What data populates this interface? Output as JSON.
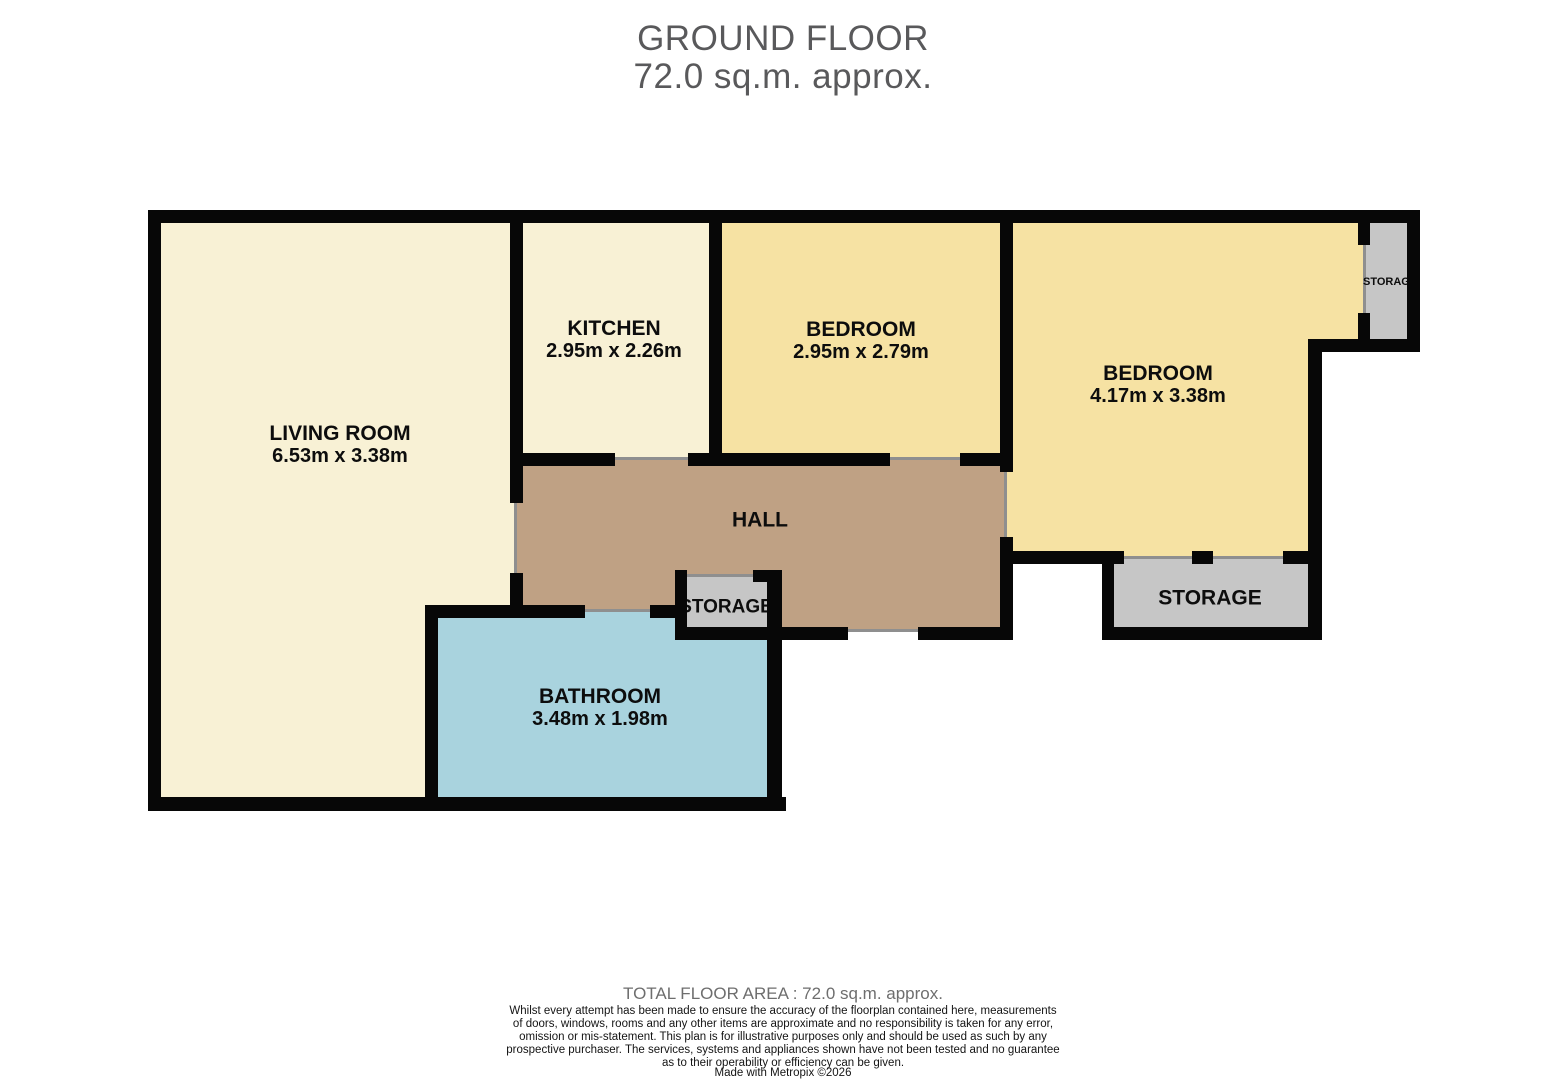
{
  "title": {
    "floor": "GROUND FLOOR",
    "area": "72.0 sq.m. approx."
  },
  "rooms": {
    "living": {
      "name": "LIVING ROOM",
      "dims": "6.53m  x 3.38m",
      "color": "#f8f1d5"
    },
    "kitchen": {
      "name": "KITCHEN",
      "dims": "2.95m  x 2.26m",
      "color": "#f8f1d5"
    },
    "bedroom1": {
      "name": "BEDROOM",
      "dims": "2.95m  x 2.79m",
      "color": "#f6e2a3"
    },
    "bedroom2": {
      "name": "BEDROOM",
      "dims": "4.17m  x 3.38m",
      "color": "#f6e2a3"
    },
    "hall": {
      "name": "HALL",
      "color": "#bfa184"
    },
    "bathroom": {
      "name": "BATHROOM",
      "dims": "3.48m  x 1.98m",
      "color": "#a9d3de"
    },
    "storage_hall": {
      "name": "STORAGE",
      "color": "#c6c6c6"
    },
    "storage_bedroom": {
      "name": "STORAGE",
      "color": "#c6c6c6"
    },
    "storage_topright": {
      "name": "STORAGE",
      "color": "#c6c6c6"
    }
  },
  "colors": {
    "wall": "#070707",
    "door_opening": "#8f8f8f",
    "title_text": "#59595b"
  },
  "footer": {
    "total": "TOTAL FLOOR AREA : 72.0 sq.m. approx.",
    "disclaimer": "Whilst every attempt has been made to ensure the accuracy of the floorplan contained here, measurements\nof doors, windows, rooms and any other items are approximate and no responsibility is taken for any error,\nomission or mis-statement. This plan is for illustrative purposes only and should be used as such by any\nprospective purchaser. The services, systems and appliances shown have not been tested and no guarantee\nas to their operability or efficiency can be given.",
    "credit": "Made with Metropix ©2026"
  }
}
